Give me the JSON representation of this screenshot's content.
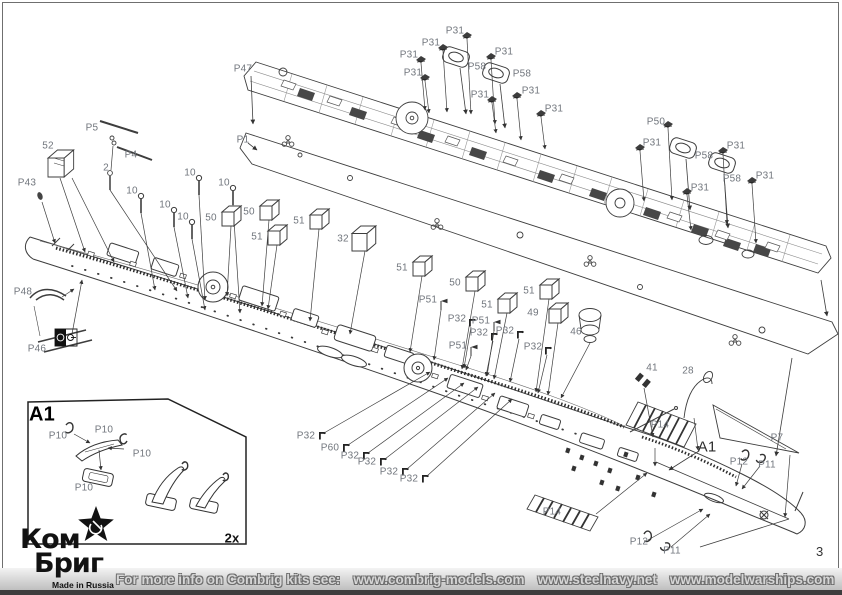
{
  "page": {
    "number": "3"
  },
  "footer": {
    "intro": "For more info on Combrig kits see:",
    "links": [
      "www.combrig-models.com",
      "www.steelnavy.net",
      "www.modelwarships.com"
    ],
    "kit_number": "35142"
  },
  "logo": {
    "line1": "Ком",
    "line2": "Бриг",
    "tagline": "Made in Russia"
  },
  "callouts": [
    {
      "t": "P47",
      "x": 243,
      "y": 69
    },
    {
      "t": "P1",
      "x": 243,
      "y": 140
    },
    {
      "t": "P31",
      "x": 455,
      "y": 31
    },
    {
      "t": "P31",
      "x": 431,
      "y": 43
    },
    {
      "t": "P31",
      "x": 409,
      "y": 55
    },
    {
      "t": "P31",
      "x": 413,
      "y": 73
    },
    {
      "t": "P58",
      "x": 477,
      "y": 67
    },
    {
      "t": "P31",
      "x": 504,
      "y": 52
    },
    {
      "t": "P58",
      "x": 522,
      "y": 74
    },
    {
      "t": "P31",
      "x": 480,
      "y": 95
    },
    {
      "t": "P31",
      "x": 531,
      "y": 91
    },
    {
      "t": "P31",
      "x": 554,
      "y": 109
    },
    {
      "t": "P50",
      "x": 656,
      "y": 122
    },
    {
      "t": "P31",
      "x": 652,
      "y": 143
    },
    {
      "t": "P58",
      "x": 704,
      "y": 156
    },
    {
      "t": "P31",
      "x": 736,
      "y": 146
    },
    {
      "t": "P58",
      "x": 732,
      "y": 179
    },
    {
      "t": "P31",
      "x": 700,
      "y": 188
    },
    {
      "t": "P31",
      "x": 765,
      "y": 176
    },
    {
      "t": "52",
      "x": 48,
      "y": 146
    },
    {
      "t": "P5",
      "x": 92,
      "y": 128
    },
    {
      "t": "P4",
      "x": 131,
      "y": 155
    },
    {
      "t": "2",
      "x": 106,
      "y": 168
    },
    {
      "t": "P43",
      "x": 27,
      "y": 183
    },
    {
      "t": "P48",
      "x": 23,
      "y": 292
    },
    {
      "t": "P46",
      "x": 37,
      "y": 349
    },
    {
      "t": "10",
      "x": 132,
      "y": 191
    },
    {
      "t": "10",
      "x": 190,
      "y": 173
    },
    {
      "t": "10",
      "x": 224,
      "y": 183
    },
    {
      "t": "10",
      "x": 165,
      "y": 205
    },
    {
      "t": "10",
      "x": 183,
      "y": 217
    },
    {
      "t": "50",
      "x": 211,
      "y": 218
    },
    {
      "t": "50",
      "x": 249,
      "y": 212
    },
    {
      "t": "51",
      "x": 299,
      "y": 221
    },
    {
      "t": "51",
      "x": 257,
      "y": 237
    },
    {
      "t": "32",
      "x": 343,
      "y": 239
    },
    {
      "t": "51",
      "x": 402,
      "y": 268
    },
    {
      "t": "50",
      "x": 455,
      "y": 283
    },
    {
      "t": "51",
      "x": 487,
      "y": 305
    },
    {
      "t": "51",
      "x": 529,
      "y": 291
    },
    {
      "t": "49",
      "x": 533,
      "y": 313
    },
    {
      "t": "46",
      "x": 576,
      "y": 332
    },
    {
      "t": "P51",
      "x": 428,
      "y": 300
    },
    {
      "t": "P32",
      "x": 457,
      "y": 319
    },
    {
      "t": "P51",
      "x": 481,
      "y": 321
    },
    {
      "t": "P32",
      "x": 479,
      "y": 333
    },
    {
      "t": "P32",
      "x": 505,
      "y": 331
    },
    {
      "t": "P51",
      "x": 458,
      "y": 346
    },
    {
      "t": "P32",
      "x": 533,
      "y": 347
    },
    {
      "t": "P32",
      "x": 306,
      "y": 436
    },
    {
      "t": "P60",
      "x": 330,
      "y": 448
    },
    {
      "t": "P32",
      "x": 350,
      "y": 456
    },
    {
      "t": "P32",
      "x": 367,
      "y": 462
    },
    {
      "t": "P32",
      "x": 389,
      "y": 472
    },
    {
      "t": "P32",
      "x": 409,
      "y": 479
    },
    {
      "t": "41",
      "x": 652,
      "y": 368
    },
    {
      "t": "28",
      "x": 688,
      "y": 371
    },
    {
      "t": "P14",
      "x": 660,
      "y": 425
    },
    {
      "t": "A1",
      "x": 707,
      "y": 447,
      "v": "section"
    },
    {
      "t": "P7",
      "x": 777,
      "y": 438
    },
    {
      "t": "P12",
      "x": 739,
      "y": 462
    },
    {
      "t": "P11",
      "x": 767,
      "y": 465
    },
    {
      "t": "P14",
      "x": 552,
      "y": 512
    },
    {
      "t": "P12",
      "x": 639,
      "y": 542
    },
    {
      "t": "P11",
      "x": 672,
      "y": 551
    },
    {
      "t": "A1",
      "x": 42,
      "y": 415,
      "v": "inset-title"
    },
    {
      "t": "P10",
      "x": 58,
      "y": 436
    },
    {
      "t": "P10",
      "x": 104,
      "y": 430
    },
    {
      "t": "P10",
      "x": 142,
      "y": 454
    },
    {
      "t": "P10",
      "x": 84,
      "y": 488
    },
    {
      "t": "2x",
      "x": 232,
      "y": 538,
      "v": "qty"
    }
  ]
}
